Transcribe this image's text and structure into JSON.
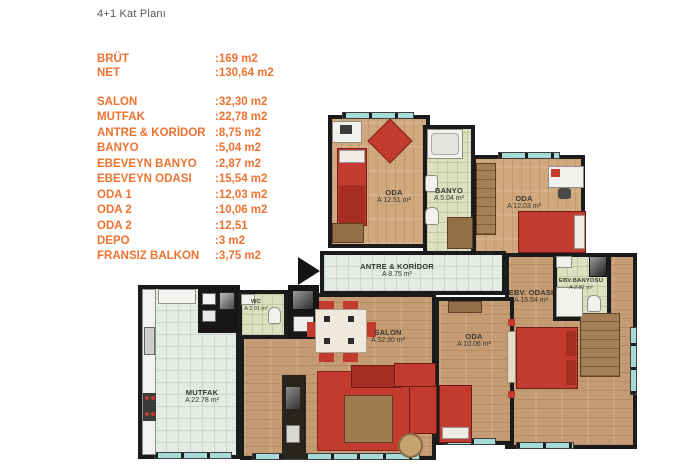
{
  "page": {
    "title": "4+1 Kat Planı"
  },
  "summary": {
    "items": [
      {
        "label": "BRÜT",
        "value": ":169 m2"
      },
      {
        "label": "NET",
        "value": ":130,64 m2"
      }
    ]
  },
  "room_list": {
    "items": [
      {
        "label": "SALON",
        "value": ":32,30 m2"
      },
      {
        "label": "MUTFAK",
        "value": ":22,78 m2"
      },
      {
        "label": "ANTRE & KORİDOR",
        "value": ":8,75 m2"
      },
      {
        "label": "BANYO",
        "value": ":5,04 m2"
      },
      {
        "label": "EBEVEYN BANYO",
        "value": ":2,87 m2"
      },
      {
        "label": "EBEVEYN ODASI",
        "value": ":15,54 m2"
      },
      {
        "label": "ODA 1",
        "value": ":12,03 m2"
      },
      {
        "label": "ODA 2",
        "value": ":10,06 m2"
      },
      {
        "label": "ODA 2",
        "value": ":12,51"
      },
      {
        "label": "DEPO",
        "value": ":3 m2"
      },
      {
        "label": "FRANSIZ BALKON",
        "value": ":3,75 m2"
      }
    ]
  },
  "floor_plan": {
    "rooms": [
      {
        "id": "oda-1251",
        "name": "ODA",
        "area": "A 12.51 m²"
      },
      {
        "id": "banyo",
        "name": "BANYO",
        "area": "A 5.04 m²"
      },
      {
        "id": "oda-1203",
        "name": "ODA",
        "area": "A 12.03 m²"
      },
      {
        "id": "antre",
        "name": "ANTRE & KORİDOR",
        "area": "A 8.75 m²"
      },
      {
        "id": "wc",
        "name": "WC",
        "area": "A 2.01 m²"
      },
      {
        "id": "mutfak",
        "name": "MUTFAK",
        "area": "A 22.78 m²"
      },
      {
        "id": "salon",
        "name": "SALON",
        "area": "A 32.30 m²"
      },
      {
        "id": "oda-1006",
        "name": "ODA",
        "area": "A 10.06 m²"
      },
      {
        "id": "ebv-odasi",
        "name": "EBV. ODASI",
        "area": "A 15.54 m²"
      },
      {
        "id": "ebv-banyo",
        "name": "EBV.BANYOSU",
        "area": "A 2.87 m²"
      }
    ],
    "colors": {
      "accent_orange": "#ed7331",
      "title_gray": "#55565a",
      "wall_black": "#1b1b1b",
      "wood_floor": "#c49b72",
      "tile_floor": "#e4eae4",
      "bath_floor": "#dcdfc0",
      "window_teal": "#a7dbd8",
      "furniture_red": "#c23b2e"
    }
  }
}
